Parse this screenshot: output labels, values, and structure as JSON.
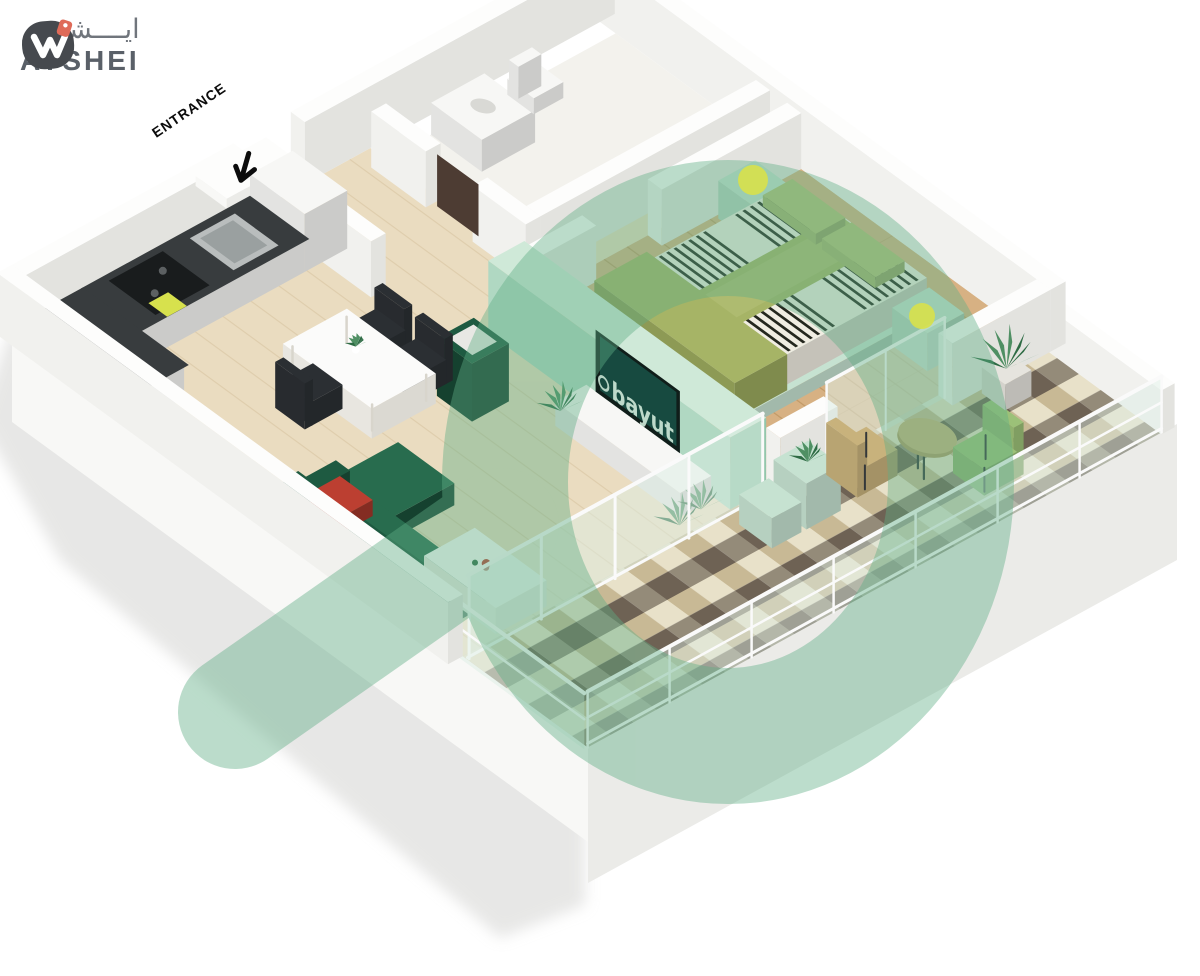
{
  "brand": {
    "name": "AYSHEI",
    "name_arabic": "ايــــشي",
    "mark_color": "#46494e",
    "tag_color": "#df6a58",
    "text_color": "#5a6068"
  },
  "labels": {
    "entrance": "ENTRANCE"
  },
  "tv": {
    "watermark_text": "bayut"
  },
  "watermark": {
    "color": "#5fae85",
    "opacity": "0.42"
  },
  "colors": {
    "wall_top": "#fdfdfc",
    "wall_left": "#f1f1ee",
    "wall_right": "#e3e3df",
    "mint_top": "#cfe9d8",
    "mint_left": "#b0d8c2",
    "mint_right": "#92c6ab",
    "floor_main": "#eadcc0",
    "floor_wood": "#d7b183",
    "floor_bath": "#f3f2ed",
    "base_left": "#f8f8f6",
    "base_right": "#ebebe8",
    "shadow": "#d4d4d2",
    "counter_top": "#383c3e",
    "cabinet_white": "#f7f7f5",
    "sofa_green": "#1e5a41",
    "sofa_light": "#286c4e",
    "sofa_dark": "#15412f",
    "accent_red": "#bc3f31",
    "table_white": "#fbfbfa",
    "chair_dark": "#2b2f33",
    "olive": "#a6b466",
    "olive_light": "#b4c077",
    "olive_dark": "#8d9a55",
    "stripe_dark": "#24271e",
    "stripe_base": "#f0ede2",
    "mint_furn": "#c6e2d1",
    "lamp_yellow": "#d7e14d",
    "plant_green": "#2e6b44",
    "plant_light": "#4f8f63",
    "glass": "#dcede4",
    "frame_white": "#fafafa",
    "tile_cream": "#e8e1c9",
    "tile_tan": "#c8b995",
    "tile_gray": "#948b79",
    "tile_brown": "#6e6254",
    "tan": "#c8b27c",
    "tan_dark": "#b09a67",
    "chair_green": "#9cc178",
    "metal_dark": "#34383a",
    "tv_frame": "#101e1a",
    "tv_screen": "#174a40",
    "tv_text": "#cfe9d9",
    "door_brown": "#4d3c33"
  }
}
